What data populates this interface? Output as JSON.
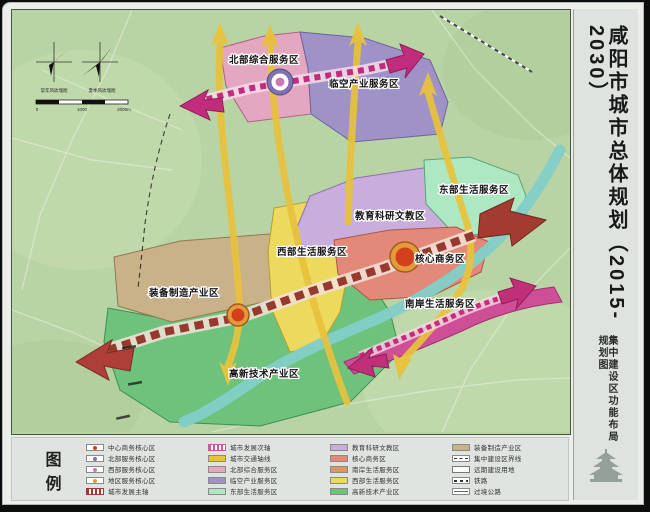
{
  "sidebar": {
    "title": "咸阳市城市总体规划（2015-2030）",
    "subtitle": "集中建设区功能布局规划图",
    "logo": "pagoda-emblem"
  },
  "map": {
    "compass": {
      "left_label": "常年风玫瑰图",
      "right_label": "夏季风玫瑰图",
      "scale_0": "0",
      "scale_mid": "1000",
      "scale_end": "2000m"
    },
    "zones": [
      {
        "id": "north-comprehensive",
        "label": "北部综合服务区",
        "color": "#e3a7c0"
      },
      {
        "id": "airport-industry",
        "label": "临空产业服务区",
        "color": "#9e92c6"
      },
      {
        "id": "east-living",
        "label": "东部生活服务区",
        "color": "#aee8c3"
      },
      {
        "id": "education-research",
        "label": "教育科研文教区",
        "color": "#c9aedd"
      },
      {
        "id": "west-living",
        "label": "西部生活服务区",
        "color": "#ecd95e"
      },
      {
        "id": "core-business",
        "label": "核心商务区",
        "color": "#e2897a"
      },
      {
        "id": "south-bank-living",
        "label": "南岸生活服务区",
        "color": "#cf4f96"
      },
      {
        "id": "equipment-manufacturing",
        "label": "装备制造产业区",
        "color": "#c9b189"
      },
      {
        "id": "hightech-industry",
        "label": "高新技术产业区",
        "color": "#6fc27c"
      }
    ],
    "accent_colors": {
      "river": "#82cfc9",
      "traffic_axis": "#e8c23c",
      "main_axis": "#97392f",
      "north_axis": "#c22c7c",
      "south_axis": "#c03078",
      "node_core": "#d2411c",
      "node_ring": "#e39a3d"
    }
  },
  "legend": {
    "title_char_1": "图",
    "title_char_2": "例",
    "columns": [
      [
        {
          "label": "中心商务核心区",
          "dot": "#d2411c"
        },
        {
          "label": "北部服务核心区",
          "dot": "#7f72b2"
        },
        {
          "label": "西部服务核心区",
          "dot": "#c97ab2"
        },
        {
          "label": "地区服务核心区",
          "dot": "#e39a3d"
        },
        {
          "label": "城市发展主轴"
        }
      ],
      [
        {
          "label": "城市发展次轴"
        },
        {
          "label": "城市交通轴线",
          "swatch": "#e8c23c"
        },
        {
          "label": "北部综合服务区",
          "swatch": "#e3a7c0"
        },
        {
          "label": "临空产业服务区",
          "swatch": "#9e92c6"
        },
        {
          "label": "东部生活服务区",
          "swatch": "#aee8c3"
        }
      ],
      [
        {
          "label": "教育科研文教区",
          "swatch": "#c9aedd"
        },
        {
          "label": "核心商务区",
          "swatch": "#e2897a"
        },
        {
          "label": "南岸生活服务区",
          "swatch": "#e0955a"
        },
        {
          "label": "西部生活服务区",
          "swatch": "#ecd95e"
        },
        {
          "label": "高新技术产业区",
          "swatch": "#6fc27c"
        }
      ],
      [
        {
          "label": "装备制造产业区",
          "swatch": "#c9b189"
        },
        {
          "label": "集中建设区界线"
        },
        {
          "label": "远期建设用地"
        },
        {
          "label": "铁路"
        },
        {
          "label": "过境公路"
        }
      ]
    ]
  }
}
